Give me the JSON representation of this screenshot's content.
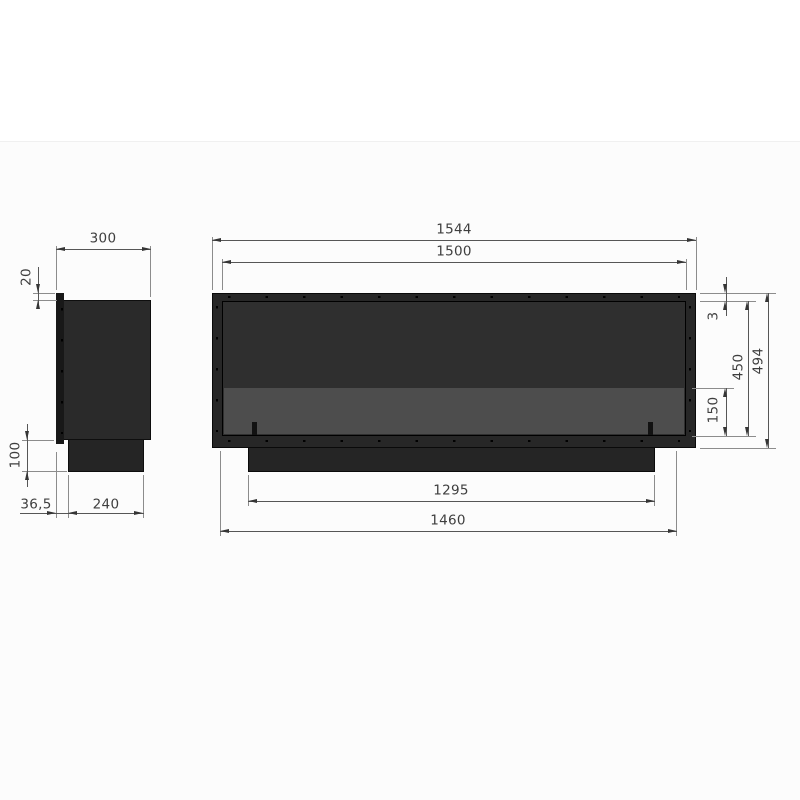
{
  "drawing": {
    "type": "technical-dimension-drawing",
    "subject": "built-in fireplace insert, side and front elevation views",
    "units": "mm",
    "views": {
      "side": {
        "label": "side-view",
        "dimensions": {
          "depth": "300",
          "top_lip": "20",
          "base_height": "100",
          "base_front_offset": "36,5",
          "base_depth": "240"
        }
      },
      "front": {
        "label": "front-view",
        "dimensions": {
          "overall_width": "1544",
          "opening_width": "1500",
          "frame_top_lip": "3",
          "opening_height": "450",
          "overall_height": "494",
          "burner_strip_height": "150",
          "base_width": "1295",
          "body_width": "1460"
        }
      }
    },
    "colors": {
      "frame": "#272727",
      "inner_panel": "#2f2f2f",
      "burner_strip": "#4d4d4d",
      "base_block": "#252525",
      "front_lip_strip": "#181818",
      "dimension_line": "#565656",
      "extension_line": "#8c8c8c",
      "dimension_text": "#3e3e3e"
    }
  }
}
